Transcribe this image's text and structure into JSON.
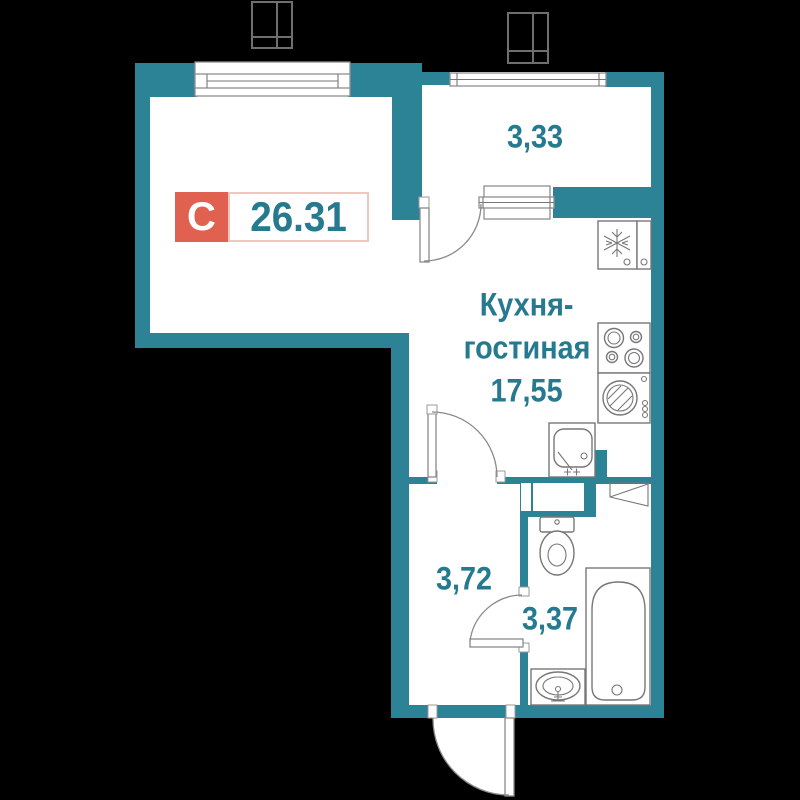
{
  "badge": {
    "letter": "С",
    "value": "26.31"
  },
  "rooms": {
    "loggia": {
      "area": "3,33"
    },
    "kitchen_living": {
      "name_line1": "Кухня-",
      "name_line2": "гостиная",
      "area": "17,55"
    },
    "hallway": {
      "area": "3,72"
    },
    "bathroom": {
      "area": "3,37"
    }
  },
  "fixtures": [
    "living-room-window",
    "loggia-glazing",
    "loggia-window",
    "loggia-door",
    "fridge-icon",
    "stove-icon",
    "washing-machine-icon",
    "kitchen-sink-icon",
    "vent-shaft",
    "toilet-icon",
    "corner-shelf-icon",
    "bathtub-icon",
    "washbasin-icon",
    "interior-door",
    "bathroom-door",
    "entrance-door",
    "duct-box-top-left",
    "duct-box-top-right"
  ],
  "colors": {
    "wall": "#2c8396",
    "label": "#257a90",
    "badge_red": "#e0614f",
    "badge_border": "#f0c7c0",
    "fixture_outline": "#777777",
    "floor": "#ffffff",
    "background": "#000000"
  }
}
